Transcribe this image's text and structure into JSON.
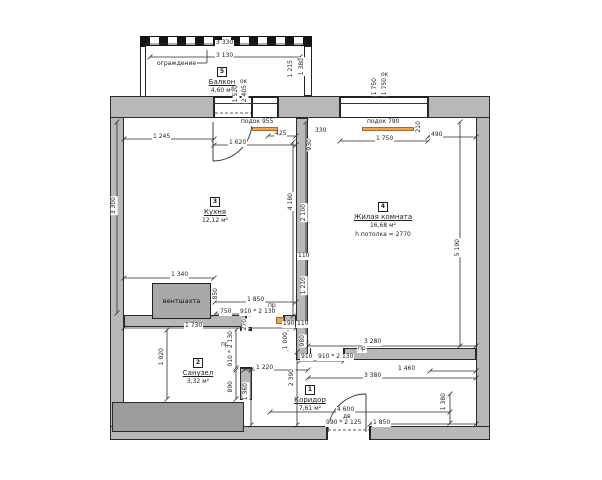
{
  "title": "floor-plan",
  "colors": {
    "wall": "#b8b8b8",
    "dark_block": "#9c9c9c",
    "sill_orange": "#eaa35f",
    "line": "#2b2b2b"
  },
  "rooms": {
    "balcony": {
      "marker": "5",
      "name": "Балкон",
      "area": "4,60 м²"
    },
    "kitchen": {
      "marker": "3",
      "name": "Кухня",
      "area": "12,12 м²"
    },
    "living": {
      "marker": "4",
      "name": "Жилая комната",
      "area": "16,68 м²",
      "ceiling": "h потолка = 2770"
    },
    "bathroom": {
      "marker": "2",
      "name": "Санузел",
      "area": "3,32 м²"
    },
    "corridor": {
      "marker": "1",
      "name": "Коридор",
      "area": "7,61 м²"
    }
  },
  "labels": {
    "vent_shaft": "вентшахта"
  },
  "dimensions": [
    {
      "t": "3 330",
      "x": 215,
      "y": 40
    },
    {
      "t": "3 130",
      "x": 215,
      "y": 53
    },
    {
      "t": "ограждение",
      "x": 156,
      "y": 61
    },
    {
      "t": "1 215",
      "x": 288,
      "y": 59,
      "v": 1
    },
    {
      "t": "1 380",
      "x": 299,
      "y": 57,
      "v": 1
    },
    {
      "t": "ок",
      "x": 239,
      "y": 79
    },
    {
      "t": "1 520",
      "x": 233,
      "y": 84,
      "v": 1
    },
    {
      "t": "2 405",
      "x": 242,
      "y": 84,
      "v": 1
    },
    {
      "t": "ок",
      "x": 380,
      "y": 72
    },
    {
      "t": "1 750",
      "x": 372,
      "y": 77,
      "v": 1
    },
    {
      "t": "1 750",
      "x": 382,
      "y": 77,
      "v": 1
    },
    {
      "t": "1 245",
      "x": 152,
      "y": 134
    },
    {
      "t": "1 620",
      "x": 228,
      "y": 140
    },
    {
      "t": "425",
      "x": 274,
      "y": 131
    },
    {
      "t": "подок 955",
      "x": 240,
      "y": 119
    },
    {
      "t": "330",
      "x": 314,
      "y": 128
    },
    {
      "t": "930",
      "x": 307,
      "y": 138,
      "v": 1
    },
    {
      "t": "подок 790",
      "x": 366,
      "y": 119
    },
    {
      "t": "1 750",
      "x": 375,
      "y": 136
    },
    {
      "t": "490",
      "x": 430,
      "y": 132
    },
    {
      "t": "210",
      "x": 416,
      "y": 120,
      "v": 1
    },
    {
      "t": "3 300",
      "x": 111,
      "y": 196,
      "v": 1
    },
    {
      "t": "5 190",
      "x": 455,
      "y": 238,
      "v": 1
    },
    {
      "t": "4 180",
      "x": 288,
      "y": 192,
      "v": 1
    },
    {
      "t": "2 100",
      "x": 301,
      "y": 203,
      "v": 1
    },
    {
      "t": "110",
      "x": 297,
      "y": 253
    },
    {
      "t": "1 210",
      "x": 301,
      "y": 276,
      "v": 1
    },
    {
      "t": "1 340",
      "x": 170,
      "y": 272
    },
    {
      "t": "850",
      "x": 213,
      "y": 287,
      "v": 1
    },
    {
      "t": "1 850",
      "x": 246,
      "y": 297
    },
    {
      "t": "пр",
      "x": 267,
      "y": 303
    },
    {
      "t": "750",
      "x": 219,
      "y": 309
    },
    {
      "t": "910 * 2 130",
      "x": 239,
      "y": 309
    },
    {
      "t": "1 730",
      "x": 184,
      "y": 323
    },
    {
      "t": "270",
      "x": 242,
      "y": 318,
      "v": 1
    },
    {
      "t": "190",
      "x": 282,
      "y": 321
    },
    {
      "t": "110",
      "x": 296,
      "y": 321
    },
    {
      "t": "1 000",
      "x": 283,
      "y": 331,
      "v": 1
    },
    {
      "t": "980",
      "x": 300,
      "y": 334,
      "v": 1
    },
    {
      "t": "3 280",
      "x": 363,
      "y": 339
    },
    {
      "t": "пр",
      "x": 357,
      "y": 346
    },
    {
      "t": "910",
      "x": 300,
      "y": 354
    },
    {
      "t": "910 * 2 130",
      "x": 317,
      "y": 354
    },
    {
      "t": "1 220",
      "x": 255,
      "y": 365
    },
    {
      "t": "2 390",
      "x": 289,
      "y": 368,
      "v": 1
    },
    {
      "t": "1 460",
      "x": 397,
      "y": 366
    },
    {
      "t": "3 380",
      "x": 363,
      "y": 373
    },
    {
      "t": "пр",
      "x": 220,
      "y": 342
    },
    {
      "t": "910 * 2 130",
      "x": 228,
      "y": 330,
      "v": 1
    },
    {
      "t": "890",
      "x": 228,
      "y": 380,
      "v": 1
    },
    {
      "t": "1 360",
      "x": 243,
      "y": 382,
      "v": 1
    },
    {
      "t": "1 920",
      "x": 159,
      "y": 347,
      "v": 1
    },
    {
      "t": "4 600",
      "x": 336,
      "y": 407
    },
    {
      "t": "дв",
      "x": 342,
      "y": 414
    },
    {
      "t": "990 * 2 125",
      "x": 325,
      "y": 420
    },
    {
      "t": "1 850",
      "x": 372,
      "y": 420
    },
    {
      "t": "1 380",
      "x": 441,
      "y": 392,
      "v": 1
    }
  ],
  "geometry": {
    "lines": [
      [
        146,
        44,
        304,
        44
      ],
      [
        150,
        57,
        300,
        57
      ],
      [
        124,
        139,
        214,
        139
      ],
      [
        214,
        145,
        296,
        145
      ],
      [
        268,
        136,
        296,
        136
      ],
      [
        340,
        141,
        428,
        141
      ],
      [
        428,
        137,
        476,
        137
      ],
      [
        117,
        122,
        117,
        313
      ],
      [
        460,
        122,
        460,
        346
      ],
      [
        293,
        142,
        293,
        316
      ],
      [
        306,
        122,
        306,
        344
      ],
      [
        124,
        278,
        214,
        278
      ],
      [
        215,
        302,
        296,
        302
      ],
      [
        215,
        314,
        252,
        314
      ],
      [
        124,
        328,
        296,
        328
      ],
      [
        308,
        346,
        476,
        346
      ],
      [
        300,
        361,
        344,
        361
      ],
      [
        244,
        370,
        308,
        370
      ],
      [
        430,
        371,
        476,
        371
      ],
      [
        308,
        378,
        476,
        378
      ],
      [
        288,
        330,
        288,
        351
      ],
      [
        297,
        352,
        297,
        425
      ],
      [
        167,
        330,
        167,
        399
      ],
      [
        236,
        330,
        236,
        368
      ],
      [
        236,
        370,
        236,
        399
      ],
      [
        251,
        370,
        251,
        425
      ],
      [
        270,
        412,
        450,
        412
      ],
      [
        370,
        424,
        476,
        424
      ],
      [
        450,
        394,
        450,
        423
      ],
      [
        193,
        63,
        207,
        63
      ],
      [
        207,
        63,
        207,
        50
      ]
    ],
    "dashed": [
      [
        215,
        113,
        251,
        113
      ],
      [
        328,
        430,
        369,
        430
      ]
    ],
    "paths": [
      "M213,122 L213,161",
      "M213,161 A39,39 0 0 0 252,122",
      "M366,394 L366,432",
      "M366,394 A38,38 0 0 0 328,432"
    ]
  }
}
